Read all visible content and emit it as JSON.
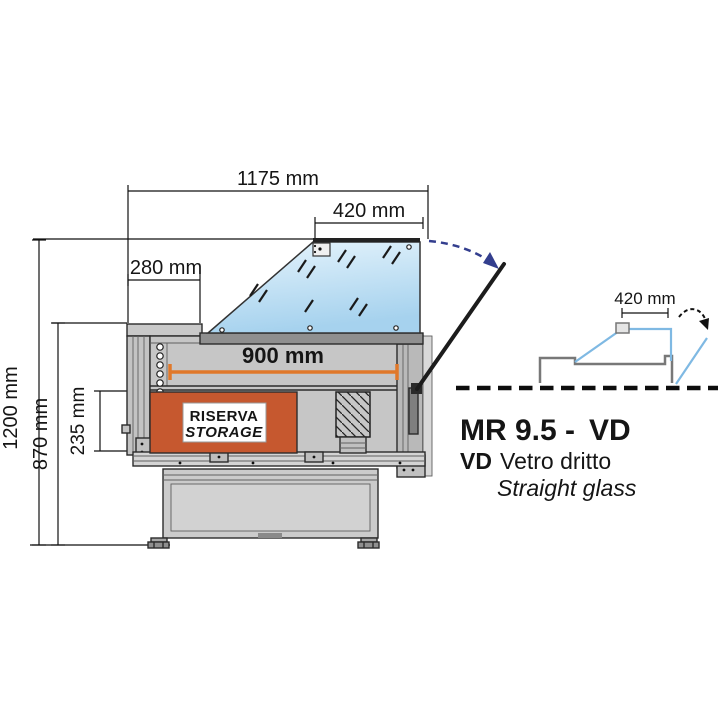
{
  "dimensions": {
    "total_width": "1175 mm",
    "glass_top_width": "420 mm",
    "rear_shelf_depth": "280 mm",
    "display_deck_width": "900 mm",
    "storage_height": "235 mm",
    "worktop_height": "870 mm",
    "total_height": "1200 mm"
  },
  "storage_label": {
    "line1": "RISERVA",
    "line2": "STORAGE"
  },
  "side_view": {
    "glass_top_width": "420 mm"
  },
  "title_block": {
    "model_name": "MR 9.5 -",
    "model_variant": "VD",
    "variant_code": "VD",
    "variant_desc_it": "Vetro dritto",
    "variant_desc_en": "Straight glass"
  },
  "colors": {
    "storage_orange": "#C6582F",
    "dimension_orange": "#E0782A",
    "model_accent_orange": "#D06A1E",
    "storage_text_blue": "#3A55A6",
    "arrow_navy": "#333E8E",
    "glass_blue": "#AED7F1",
    "side_glass_line": "#7FB9E3",
    "body_gray": "#C6C6C6"
  }
}
